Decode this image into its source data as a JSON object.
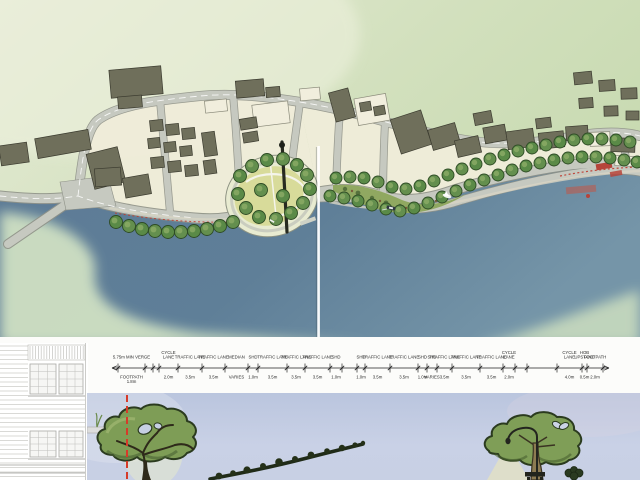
{
  "colors": {
    "land": "#dfe6cf",
    "land_deep": "#c6d9af",
    "water_left": "#5d7b96",
    "water_right": "#7595a8",
    "shallow_bank": "#cfe0c3",
    "road_fill": "#c6c9c0",
    "road_edge": "#8f9288",
    "building_dark": "#6f6f5b",
    "building_cream": "#f1eedd",
    "tree_green": "#5a8a47",
    "park_lawn": "#d8db9a",
    "sky_top": "#bac5de",
    "sky_bottom": "#cdd4e8",
    "accent_red": "#bf3a2e",
    "boundary_red": "#d63b2a",
    "sketch_grey": "#c9c9c4"
  },
  "dimension_strip": {
    "x0": 18,
    "baseline_y": 24,
    "font_size": 4.3,
    "segments": [
      {
        "t": [
          "5.75m MIN VERGE"
        ],
        "b": [
          "FOOTPATH",
          "1.8m"
        ],
        "w": 27
      },
      {
        "t": [],
        "b": [],
        "w": 8
      },
      {
        "t": [],
        "b": [],
        "w": 6
      },
      {
        "t": [
          "CYCLE",
          "LANE"
        ],
        "b": [
          "2.0m"
        ],
        "w": 19
      },
      {
        "t": [
          "TRAFFIC LANE"
        ],
        "b": [
          "3.5m"
        ],
        "w": 24
      },
      {
        "t": [
          "TRAFFIC LANE"
        ],
        "b": [
          "3.5m"
        ],
        "w": 23
      },
      {
        "t": [
          "MEDIAN"
        ],
        "b": [
          "VARIES"
        ],
        "w": 23
      },
      {
        "t": [
          "SHD"
        ],
        "b": [
          "1.0m"
        ],
        "w": 10
      },
      {
        "t": [
          "TRAFFIC LANE"
        ],
        "b": [
          "3.5m"
        ],
        "w": 29
      },
      {
        "t": [
          "TRAFFIC LANE"
        ],
        "b": [
          "3.5m"
        ],
        "w": 18
      },
      {
        "t": [
          "TRAFFIC LANE"
        ],
        "b": [
          "3.5m"
        ],
        "w": 25
      },
      {
        "t": [
          "SHD"
        ],
        "b": [
          "1.0m"
        ],
        "w": 12
      },
      {
        "t": [],
        "b": [],
        "w": 15
      },
      {
        "t": [
          "SHD"
        ],
        "b": [
          "1.0m"
        ],
        "w": 8
      },
      {
        "t": [
          "TRAFFIC LANE"
        ],
        "b": [
          "3.5m"
        ],
        "w": 25
      },
      {
        "t": [
          "TRAFFIC LANE"
        ],
        "b": [
          "3.5m"
        ],
        "w": 28
      },
      {
        "t": [
          "SHD"
        ],
        "b": [
          "1.0m"
        ],
        "w": 9
      },
      {
        "t": [
          "SHD"
        ],
        "b": [
          "VARIES"
        ],
        "w": 10
      },
      {
        "t": [
          "TRAFFIC LANE"
        ],
        "b": [
          "3.5m"
        ],
        "w": 15
      },
      {
        "t": [
          "TRAFFIC LANE"
        ],
        "b": [
          "3.5m"
        ],
        "w": 28
      },
      {
        "t": [
          "TRAFFIC LANE"
        ],
        "b": [
          "3.5m"
        ],
        "w": 23
      },
      {
        "t": [
          "CYCLE",
          "LANE"
        ],
        "b": [
          "2.0m"
        ],
        "w": 12
      },
      {
        "t": [],
        "b": [],
        "w": 12
      },
      {
        "t": [],
        "b": [],
        "w": 30
      },
      {
        "t": [
          "CYCLE",
          "LANE"
        ],
        "b": [
          "4.0m"
        ],
        "w": 25
      },
      {
        "t": [
          "HOB",
          "UPSTAND"
        ],
        "b": [
          "0.5m"
        ],
        "w": 5
      },
      {
        "t": [
          "FOOTPATH"
        ],
        "b": [
          "2.0m"
        ],
        "w": 16
      }
    ]
  },
  "plan": {
    "tree_rows": [
      {
        "name": "waterfront-west",
        "r": 6.5,
        "pts": [
          [
            116,
            222
          ],
          [
            129,
            226
          ],
          [
            142,
            229
          ],
          [
            155,
            231
          ],
          [
            168,
            232
          ],
          [
            181,
            232
          ],
          [
            194,
            231
          ],
          [
            207,
            229
          ],
          [
            220,
            226
          ],
          [
            233,
            222
          ]
        ]
      },
      {
        "name": "promontory-ring",
        "r": 6.5,
        "pts": [
          [
            240,
            176
          ],
          [
            252,
            166
          ],
          [
            267,
            160
          ],
          [
            283,
            159
          ],
          [
            297,
            165
          ],
          [
            307,
            175
          ],
          [
            310,
            189
          ],
          [
            303,
            203
          ],
          [
            291,
            213
          ],
          [
            276,
            219
          ],
          [
            259,
            217
          ],
          [
            246,
            208
          ],
          [
            238,
            194
          ],
          [
            261,
            190
          ],
          [
            283,
            196
          ]
        ]
      },
      {
        "name": "boulevard-upper",
        "r": 6,
        "pts": [
          [
            336,
            178
          ],
          [
            350,
            177
          ],
          [
            364,
            178
          ],
          [
            378,
            182
          ],
          [
            392,
            187
          ],
          [
            406,
            189
          ],
          [
            420,
            186
          ],
          [
            434,
            181
          ],
          [
            448,
            175
          ],
          [
            462,
            169
          ],
          [
            476,
            164
          ],
          [
            490,
            159
          ],
          [
            504,
            155
          ],
          [
            518,
            151
          ],
          [
            532,
            148
          ],
          [
            546,
            145
          ],
          [
            560,
            142
          ],
          [
            574,
            140
          ],
          [
            588,
            139
          ],
          [
            602,
            139
          ],
          [
            616,
            140
          ],
          [
            630,
            142
          ]
        ]
      },
      {
        "name": "boulevard-lower",
        "r": 6,
        "pts": [
          [
            330,
            196
          ],
          [
            344,
            198
          ],
          [
            358,
            201
          ],
          [
            372,
            205
          ],
          [
            386,
            209
          ],
          [
            400,
            211
          ],
          [
            414,
            208
          ],
          [
            428,
            203
          ],
          [
            442,
            197
          ],
          [
            456,
            191
          ],
          [
            470,
            185
          ],
          [
            484,
            180
          ],
          [
            498,
            175
          ],
          [
            512,
            170
          ],
          [
            526,
            166
          ],
          [
            540,
            163
          ],
          [
            554,
            160
          ],
          [
            568,
            158
          ],
          [
            582,
            157
          ],
          [
            596,
            157
          ],
          [
            610,
            158
          ],
          [
            624,
            160
          ],
          [
            637,
            162
          ]
        ]
      }
    ],
    "buildings": [
      [
        110,
        68,
        52,
        28,
        -5,
        "d"
      ],
      [
        118,
        96,
        24,
        12,
        -5,
        "d"
      ],
      [
        36,
        134,
        54,
        20,
        -10,
        "d"
      ],
      [
        0,
        144,
        28,
        20,
        -8,
        "d"
      ],
      [
        90,
        150,
        32,
        36,
        -14,
        "d"
      ],
      [
        95,
        168,
        26,
        18,
        -4,
        "d"
      ],
      [
        124,
        176,
        26,
        20,
        -10,
        "d"
      ],
      [
        150,
        120,
        13,
        11,
        -6,
        "d"
      ],
      [
        166,
        124,
        13,
        11,
        -6,
        "d"
      ],
      [
        182,
        128,
        13,
        11,
        -6,
        "d"
      ],
      [
        148,
        138,
        12,
        10,
        -6,
        "d"
      ],
      [
        164,
        142,
        12,
        10,
        -6,
        "d"
      ],
      [
        180,
        146,
        12,
        10,
        -6,
        "d"
      ],
      [
        151,
        157,
        13,
        11,
        -6,
        "d"
      ],
      [
        168,
        161,
        13,
        11,
        -6,
        "d"
      ],
      [
        185,
        165,
        13,
        11,
        -6,
        "d"
      ],
      [
        203,
        132,
        13,
        24,
        -8,
        "d"
      ],
      [
        204,
        160,
        12,
        14,
        -8,
        "d"
      ],
      [
        205,
        100,
        22,
        12,
        -6,
        "c"
      ],
      [
        236,
        80,
        28,
        17,
        -5,
        "d"
      ],
      [
        266,
        87,
        14,
        10,
        -5,
        "d"
      ],
      [
        253,
        103,
        36,
        22,
        -7,
        "c"
      ],
      [
        240,
        118,
        17,
        11,
        -9,
        "d"
      ],
      [
        243,
        132,
        15,
        10,
        -9,
        "d"
      ],
      [
        300,
        88,
        20,
        12,
        -5,
        "c"
      ],
      [
        332,
        90,
        20,
        30,
        -15,
        "d"
      ],
      [
        356,
        96,
        32,
        27,
        -10,
        "c"
      ],
      [
        360,
        102,
        11,
        9,
        -10,
        "d"
      ],
      [
        374,
        106,
        11,
        9,
        -10,
        "d"
      ],
      [
        395,
        114,
        32,
        36,
        -18,
        "d"
      ],
      [
        430,
        126,
        28,
        21,
        -16,
        "d"
      ],
      [
        456,
        138,
        24,
        17,
        -13,
        "d"
      ],
      [
        474,
        112,
        18,
        12,
        -11,
        "d"
      ],
      [
        484,
        126,
        22,
        16,
        -10,
        "d"
      ],
      [
        507,
        130,
        27,
        18,
        -8,
        "d"
      ],
      [
        536,
        118,
        15,
        10,
        -7,
        "d"
      ],
      [
        539,
        132,
        25,
        16,
        -6,
        "d"
      ],
      [
        566,
        126,
        22,
        14,
        -4,
        "d"
      ],
      [
        590,
        132,
        20,
        14,
        -2,
        "c"
      ],
      [
        611,
        138,
        24,
        14,
        2,
        "d"
      ],
      [
        574,
        72,
        18,
        12,
        -6,
        "d"
      ],
      [
        599,
        80,
        16,
        11,
        -4,
        "d"
      ],
      [
        621,
        88,
        16,
        11,
        -2,
        "d"
      ],
      [
        579,
        98,
        14,
        10,
        -4,
        "d"
      ],
      [
        604,
        106,
        14,
        10,
        -2,
        "d"
      ],
      [
        626,
        111,
        13,
        9,
        0,
        "d"
      ],
      [
        615,
        156,
        20,
        10,
        3,
        "c"
      ]
    ],
    "boats": [
      {
        "x": 447,
        "y": 196,
        "kind": "sail"
      },
      {
        "x": 391,
        "y": 208,
        "kind": "motor"
      },
      {
        "x": 272,
        "y": 221,
        "kind": "small"
      }
    ]
  }
}
